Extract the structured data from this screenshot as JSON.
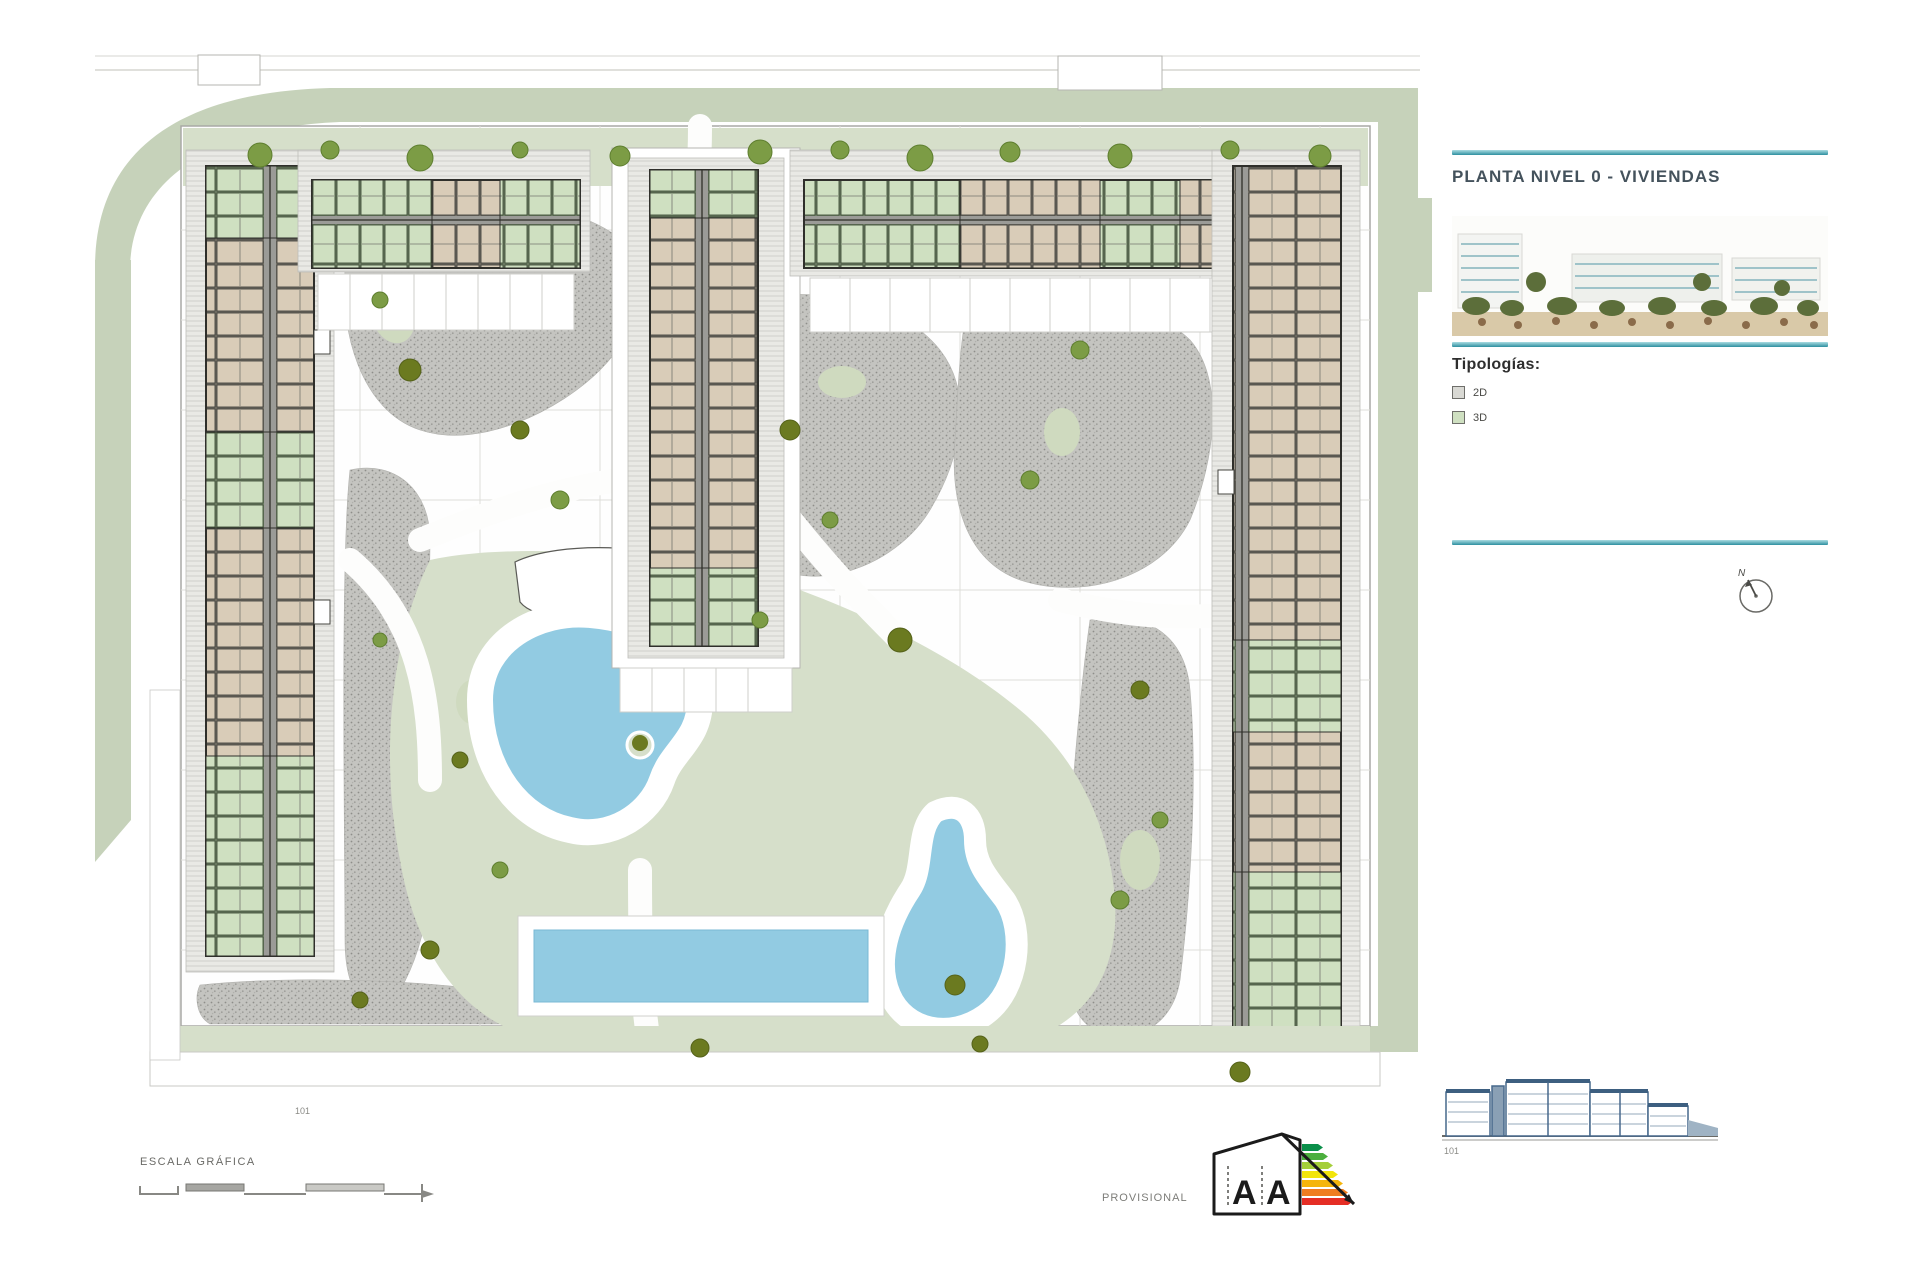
{
  "title_block": {
    "title": "PLANTA NIVEL 0 - VIVIENDAS",
    "legend_heading": "Tipologías:",
    "legend_items": [
      {
        "label": "2D",
        "swatch_color": "#d9d9d4"
      },
      {
        "label": "3D",
        "swatch_color": "#cfe0c1"
      }
    ],
    "compass_label": "N"
  },
  "footer": {
    "scale_label": "ESCALA GRÁFICA",
    "provisional_label": "PROVISIONAL",
    "energy_letters": [
      "A",
      "A"
    ],
    "plan_ref_label": "101",
    "elevation_ref_label": "101"
  },
  "colors": {
    "accent_teal": "#35919f",
    "boundary_sage": "#c6d2ba",
    "lawn_green": "#d6dfca",
    "gravel_grey": "#c2c2be",
    "pool_blue": "#92cbe2",
    "unit_tan": "#d9ccb8",
    "unit_green": "#cfe0c1",
    "wall_dark": "#3a3a36",
    "energy_bar_colors": [
      "#0a8f4a",
      "#4caf3e",
      "#a5cf3a",
      "#f2e50c",
      "#f5b50c",
      "#ef7d21",
      "#e52e25"
    ]
  }
}
